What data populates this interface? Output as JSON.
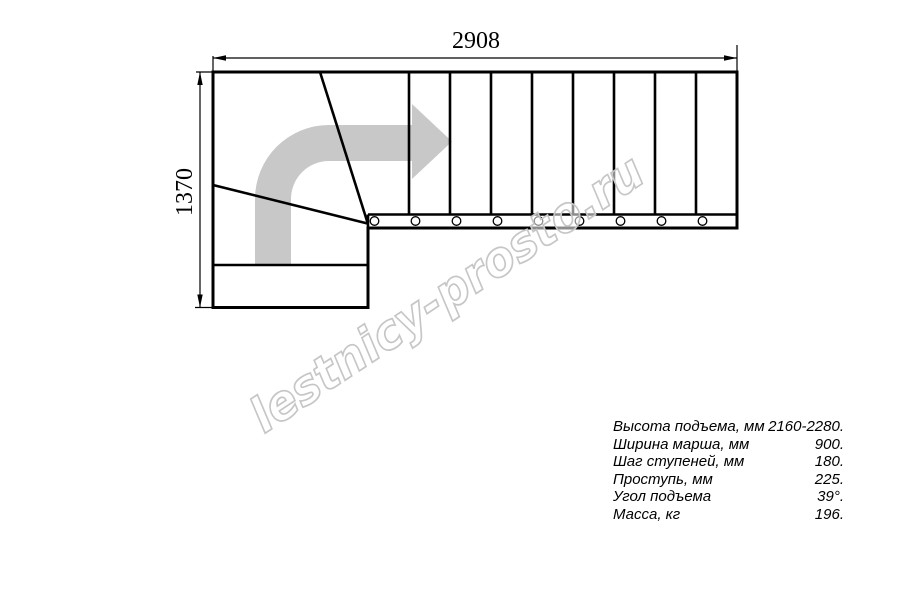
{
  "drawing": {
    "top_dimension": "2908",
    "left_dimension": "1370",
    "watermark": "lestnicy-prosto.ru",
    "colors": {
      "line": "#000000",
      "arrow_gray": "#c8c8c8",
      "watermark_gray": "#c6c6c6"
    }
  },
  "specs": {
    "rows": [
      {
        "label": "Высота подъема, мм",
        "value": "2160-2280."
      },
      {
        "label": "Ширина марша, мм",
        "value": "900."
      },
      {
        "label": "Шаг ступеней, мм",
        "value": "180."
      },
      {
        "label": "Проступь, мм",
        "value": "225."
      },
      {
        "label": "Угол подъема",
        "value": "39°."
      },
      {
        "label": "Масса, кг",
        "value": "196."
      }
    ]
  }
}
